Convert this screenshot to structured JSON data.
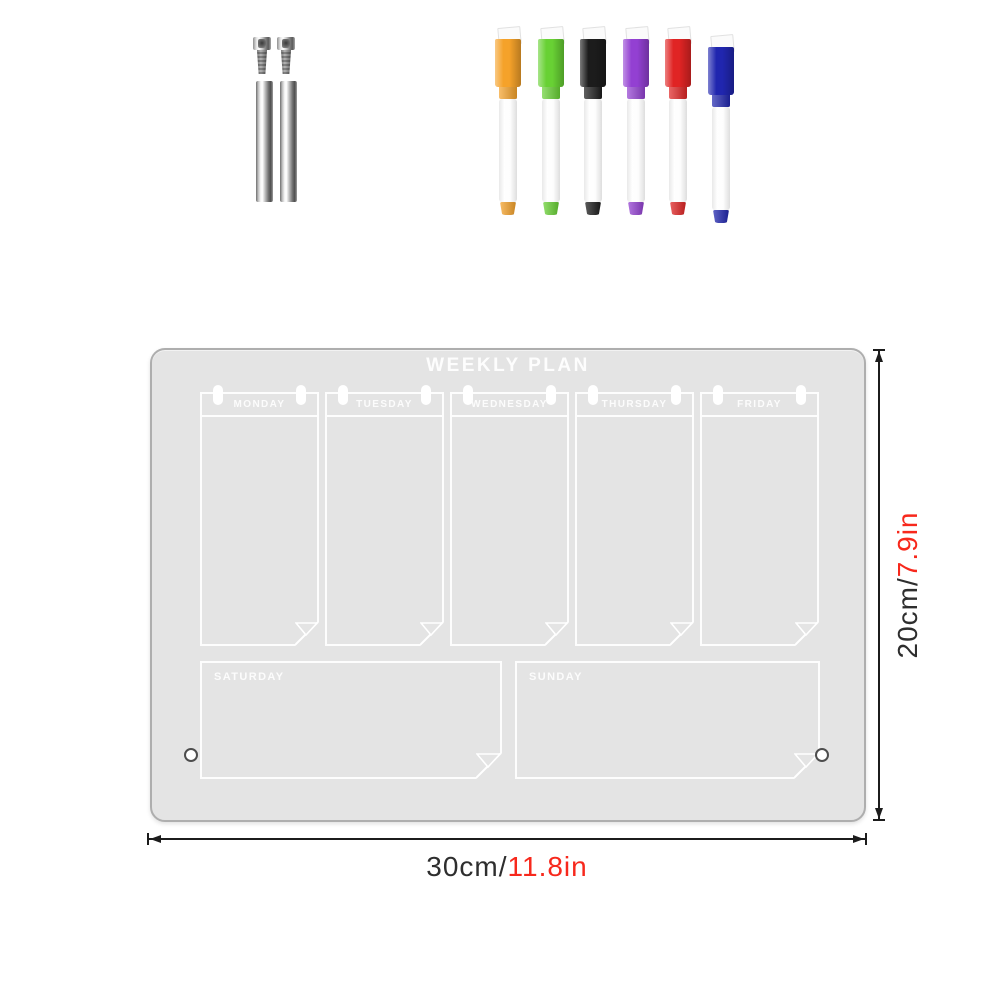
{
  "board": {
    "title": "WEEKLY PLAN",
    "weekdays": [
      "MONDAY",
      "TUESDAY",
      "WEDNESDAY",
      "THURSDAY",
      "FRIDAY"
    ],
    "weekend": [
      "SATURDAY",
      "SUNDAY"
    ],
    "surface_color": "#e4e4e4",
    "line_color": "#ffffff"
  },
  "markers": [
    {
      "name": "orange dry-erase marker",
      "color": "#f5a22a"
    },
    {
      "name": "green dry-erase marker",
      "color": "#68d134"
    },
    {
      "name": "black dry-erase marker",
      "color": "#1c1c1c"
    },
    {
      "name": "purple dry-erase marker",
      "color": "#9340d2"
    },
    {
      "name": "red dry-erase marker",
      "color": "#e02424"
    },
    {
      "name": "blue dry-erase marker",
      "color": "#2026af"
    }
  ],
  "dimensions": {
    "width_metric": "30cm/",
    "width_imperial": "11.8in",
    "height_metric": "20cm/",
    "height_imperial": "7.9in",
    "metric_color": "#2e2e2e",
    "imperial_color": "#f7281c"
  }
}
